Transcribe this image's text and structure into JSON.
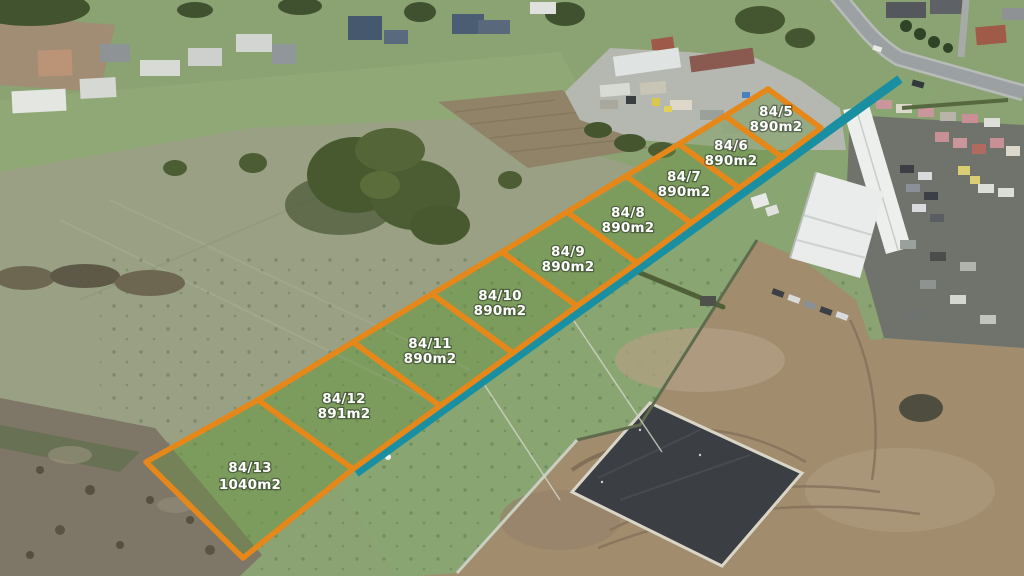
{
  "overlay": {
    "colors": {
      "plot_border": "#e6871a",
      "road_line": "#1a8fa1",
      "label_text": "#ffffff"
    },
    "parcels": [
      {
        "id": "84/5",
        "area": "890m2"
      },
      {
        "id": "84/6",
        "area": "890m2"
      },
      {
        "id": "84/7",
        "area": "890m2"
      },
      {
        "id": "84/8",
        "area": "890m2"
      },
      {
        "id": "84/9",
        "area": "890m2"
      },
      {
        "id": "84/10",
        "area": "890m2"
      },
      {
        "id": "84/11",
        "area": "890m2"
      },
      {
        "id": "84/12",
        "area": "891m2"
      },
      {
        "id": "84/13",
        "area": "1040m2"
      }
    ]
  }
}
